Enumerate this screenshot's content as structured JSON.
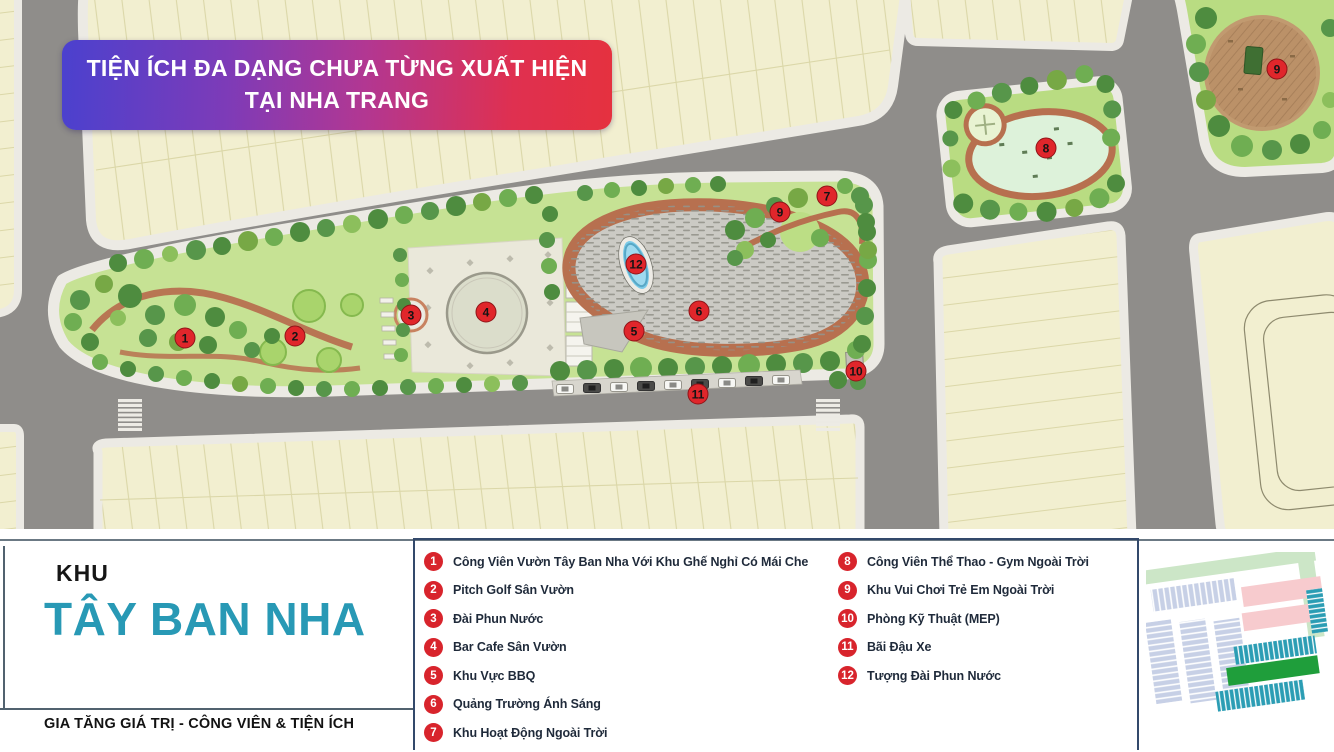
{
  "banner": {
    "line1": "TIỆN ÍCH ĐA DẠNG CHƯA TỪNG XUẤT HIỆN",
    "line2": "TẠI NHA TRANG"
  },
  "panel": {
    "kicker": "KHU",
    "title": "TÂY BAN NHA",
    "tagline": "GIA TĂNG GIÁ TRỊ - CÔNG VIÊN & TIỆN ÍCH"
  },
  "legend": {
    "left": [
      {
        "num": "1",
        "label": "Công Viên Vườn Tây Ban Nha Với Khu Ghế Nghỉ Có Mái Che"
      },
      {
        "num": "2",
        "label": "Pitch Golf Sân Vườn"
      },
      {
        "num": "3",
        "label": "Đài Phun Nước"
      },
      {
        "num": "4",
        "label": "Bar Cafe Sân Vườn"
      },
      {
        "num": "5",
        "label": "Khu Vực BBQ"
      },
      {
        "num": "6",
        "label": "Quảng Trường Ánh Sáng"
      },
      {
        "num": "7",
        "label": "Khu Hoạt Động Ngoài Trời"
      }
    ],
    "right": [
      {
        "num": "8",
        "label": "Công Viên Thể Thao - Gym Ngoài Trời"
      },
      {
        "num": "9",
        "label": "Khu Vui Chơi Trẻ Em Ngoài Trời"
      },
      {
        "num": "10",
        "label": "Phòng Kỹ Thuật (MEP)"
      },
      {
        "num": "11",
        "label": "Bãi Đậu Xe"
      },
      {
        "num": "12",
        "label": "Tượng Đài Phun Nước"
      }
    ]
  },
  "map": {
    "markers": [
      {
        "n": "1",
        "x": 185,
        "y": 338
      },
      {
        "n": "2",
        "x": 295,
        "y": 336
      },
      {
        "n": "3",
        "x": 411,
        "y": 315
      },
      {
        "n": "4",
        "x": 486,
        "y": 312
      },
      {
        "n": "5",
        "x": 634,
        "y": 331
      },
      {
        "n": "6",
        "x": 699,
        "y": 311
      },
      {
        "n": "7",
        "x": 827,
        "y": 196
      },
      {
        "n": "9",
        "x": 780,
        "y": 212
      },
      {
        "n": "10",
        "x": 856,
        "y": 371
      },
      {
        "n": "11",
        "x": 698,
        "y": 394
      },
      {
        "n": "12",
        "x": 636,
        "y": 264
      },
      {
        "n": "8",
        "x": 1046,
        "y": 148
      },
      {
        "n": "9",
        "x": 1277,
        "y": 69
      }
    ]
  },
  "colors": {
    "accent_teal": "#2899B5",
    "legend_red": "#D8242C",
    "marker_red": "#E0262B",
    "banner_blue": "#4B41CE",
    "banner_red": "#E5313F",
    "road_gray": "#8F8D8A",
    "lot_cream": "#F2EFD0",
    "park_green": "#C6E294"
  }
}
